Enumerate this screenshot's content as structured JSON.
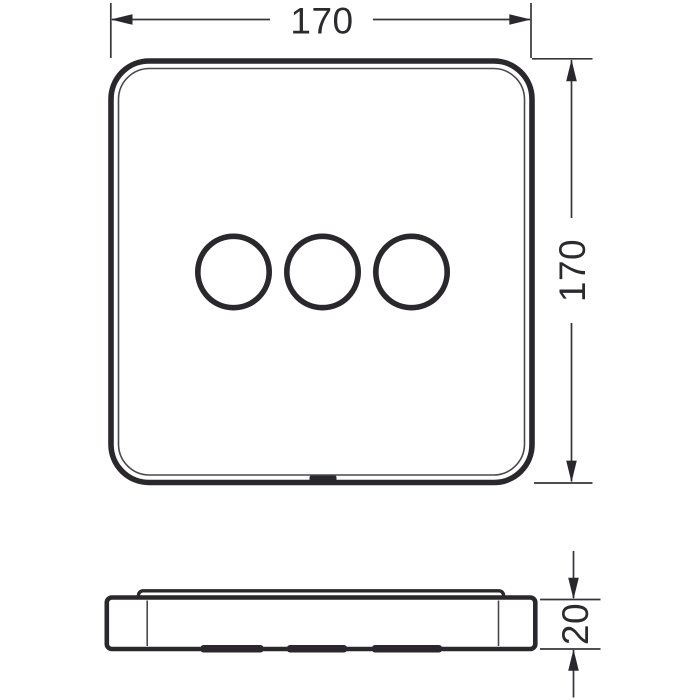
{
  "document": {
    "type": "technical-dimension-drawing",
    "background_color": "#ffffff",
    "line_color": "#2a282d"
  },
  "front_view": {
    "shape": "rounded-square-plate",
    "opening_count": "3"
  },
  "side_view": {
    "shape": "flat-plate-profile"
  },
  "dimensions": {
    "width": {
      "label": "170"
    },
    "height": {
      "label": "170"
    },
    "depth": {
      "label": "20"
    }
  }
}
